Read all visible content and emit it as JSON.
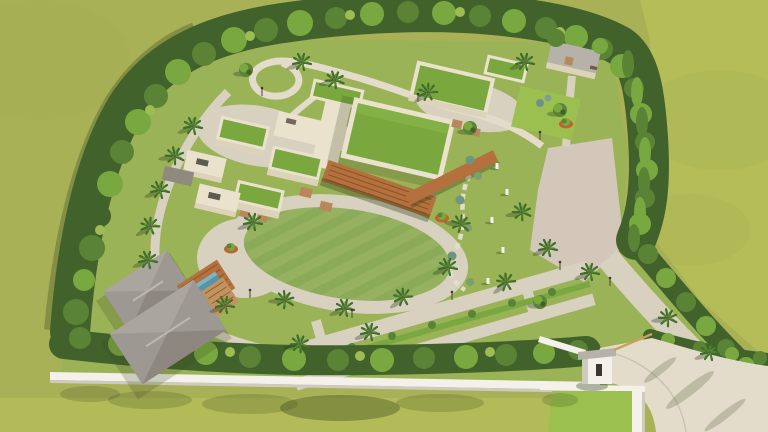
{
  "image": {
    "type": "3d-aerial-architectural-render",
    "description": "Bird's-eye 3D rendering of a walled villa compound: flat-roofed buildings with green sedum roofs and a wooden pergola, a central oval lawn ringed by palms, two hip-roofed guest cottages with a small pool, winding garden paths, a paved plaza, a dense perimeter tree belt, a white boundary wall and a gated entrance driveway at the lower right, surrounded by open olive-green fields.",
    "visible_text": "",
    "colors": {
      "field": "#a8b156",
      "fieldLight": "#b6bf58",
      "fieldDark": "#9aa54b",
      "lawn": "#9ab357",
      "lawnBright": "#9cc04f",
      "mowStripeA": "#8cab58",
      "mowStripeB": "#96b261",
      "pavement": "#d8d1c0",
      "pavementLight": "#e3dccb",
      "plaza": "#d3c7b9",
      "roofGreen": "#7ba83e",
      "parapet": "#eae2cd",
      "wallCream": "#ddd3bb",
      "wallCreamShade": "#b5a98d",
      "woodSlat": "#b9885a",
      "pergola": "#b4703d",
      "pergolaDark": "#8a5428",
      "grayRoof": "#b7b2a9",
      "cottageRoof": "#9d9892",
      "cottageRoofLight": "#aaa59e",
      "cottageRoofDark": "#8d8780",
      "deck": "#c0945f",
      "pool": "#5894a9",
      "wallWhite": "#f3f1ea",
      "wallWhiteShade": "#cfcabd",
      "planter": "#c0642e",
      "trunk": "#6e5a40",
      "treeDark": "#42622c",
      "treeMid": "#5b8336",
      "treeBright": "#79a841",
      "treeLight": "#9dbd53",
      "palmFrond": "#3f6d2a",
      "palmFrondLight": "#5e9038"
    }
  }
}
